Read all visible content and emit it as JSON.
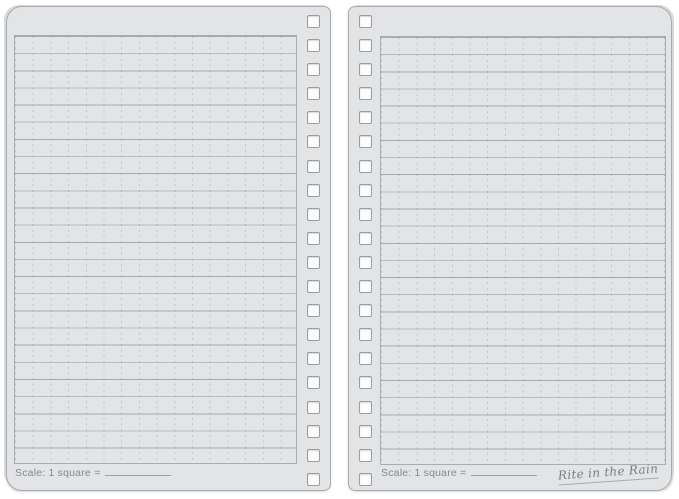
{
  "spread": {
    "description": "Blank spiral notebook open spread with universal grid pattern",
    "paper_color": "#e3e4e6",
    "line_color": "#b3b6ba",
    "dash_color": "#c1c4c8",
    "border_color": "#a7abaf",
    "background_color": "#ffffff",
    "grid_square_px": 17
  },
  "binding": {
    "holes_per_page": 20,
    "hole_shape": "square",
    "hole_fill": "#fcfcfd"
  },
  "left_page": {
    "scale_label": "Scale: 1 square ="
  },
  "right_page": {
    "scale_label": "Scale: 1 square =",
    "brand_logo": "Rite in the Rain"
  }
}
